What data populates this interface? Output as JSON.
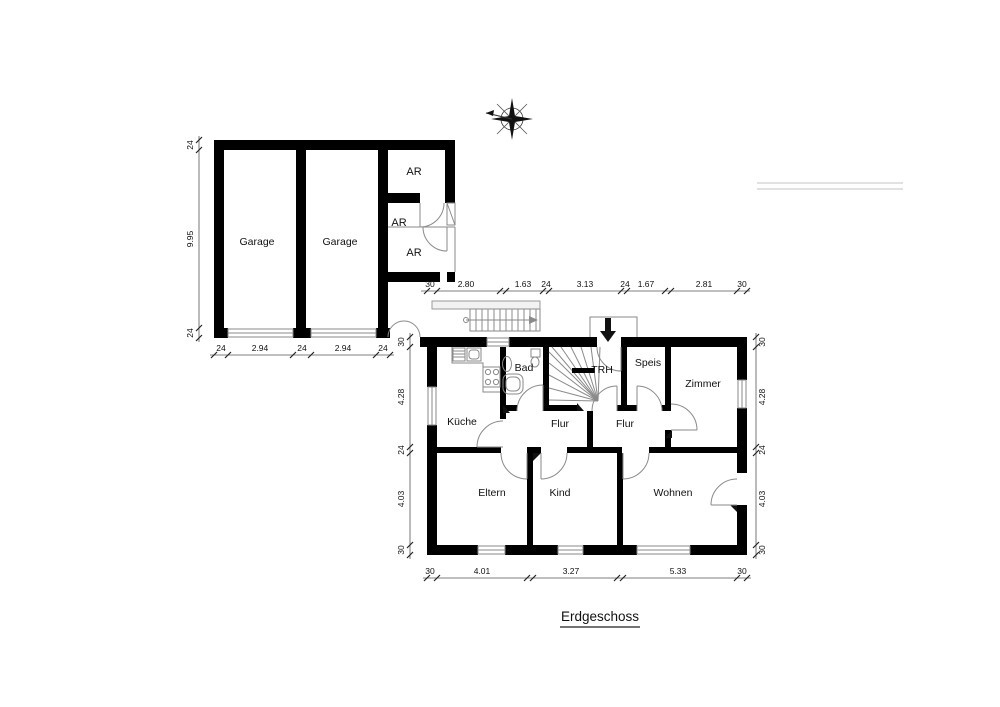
{
  "drawing": {
    "title": "Erdgeschoss"
  },
  "rooms": {
    "garage1": "Garage",
    "garage2": "Garage",
    "ar1": "AR",
    "ar2": "AR",
    "ar3": "AR",
    "kueche": "Küche",
    "bad": "Bad",
    "trh": "TRH",
    "speis": "Speis",
    "zimmer": "Zimmer",
    "flur1": "Flur",
    "flur2": "Flur",
    "eltern": "Eltern",
    "kind": "Kind",
    "wohnen": "Wohnen"
  },
  "dimensions": {
    "garage_left": [
      "24",
      "9.95",
      "24"
    ],
    "garage_bottom": [
      "24",
      "2.94",
      "24",
      "2.94",
      "24"
    ],
    "house_top": [
      "30",
      "2.80",
      "1.63",
      "24",
      "3.13",
      "24",
      "1.67",
      "2.81",
      "30"
    ],
    "house_left": [
      "30",
      "4.28",
      "24",
      "4.03",
      "30"
    ],
    "house_right": [
      "30",
      "4.28",
      "24",
      "4.03",
      "30"
    ],
    "house_bottom": [
      "30",
      "4.01",
      "3.27",
      "5.33",
      "30"
    ]
  },
  "colors": {
    "wall": "#000000",
    "fixture_line": "#8a8a8a",
    "dim_text": "#111111",
    "background": "#ffffff"
  }
}
